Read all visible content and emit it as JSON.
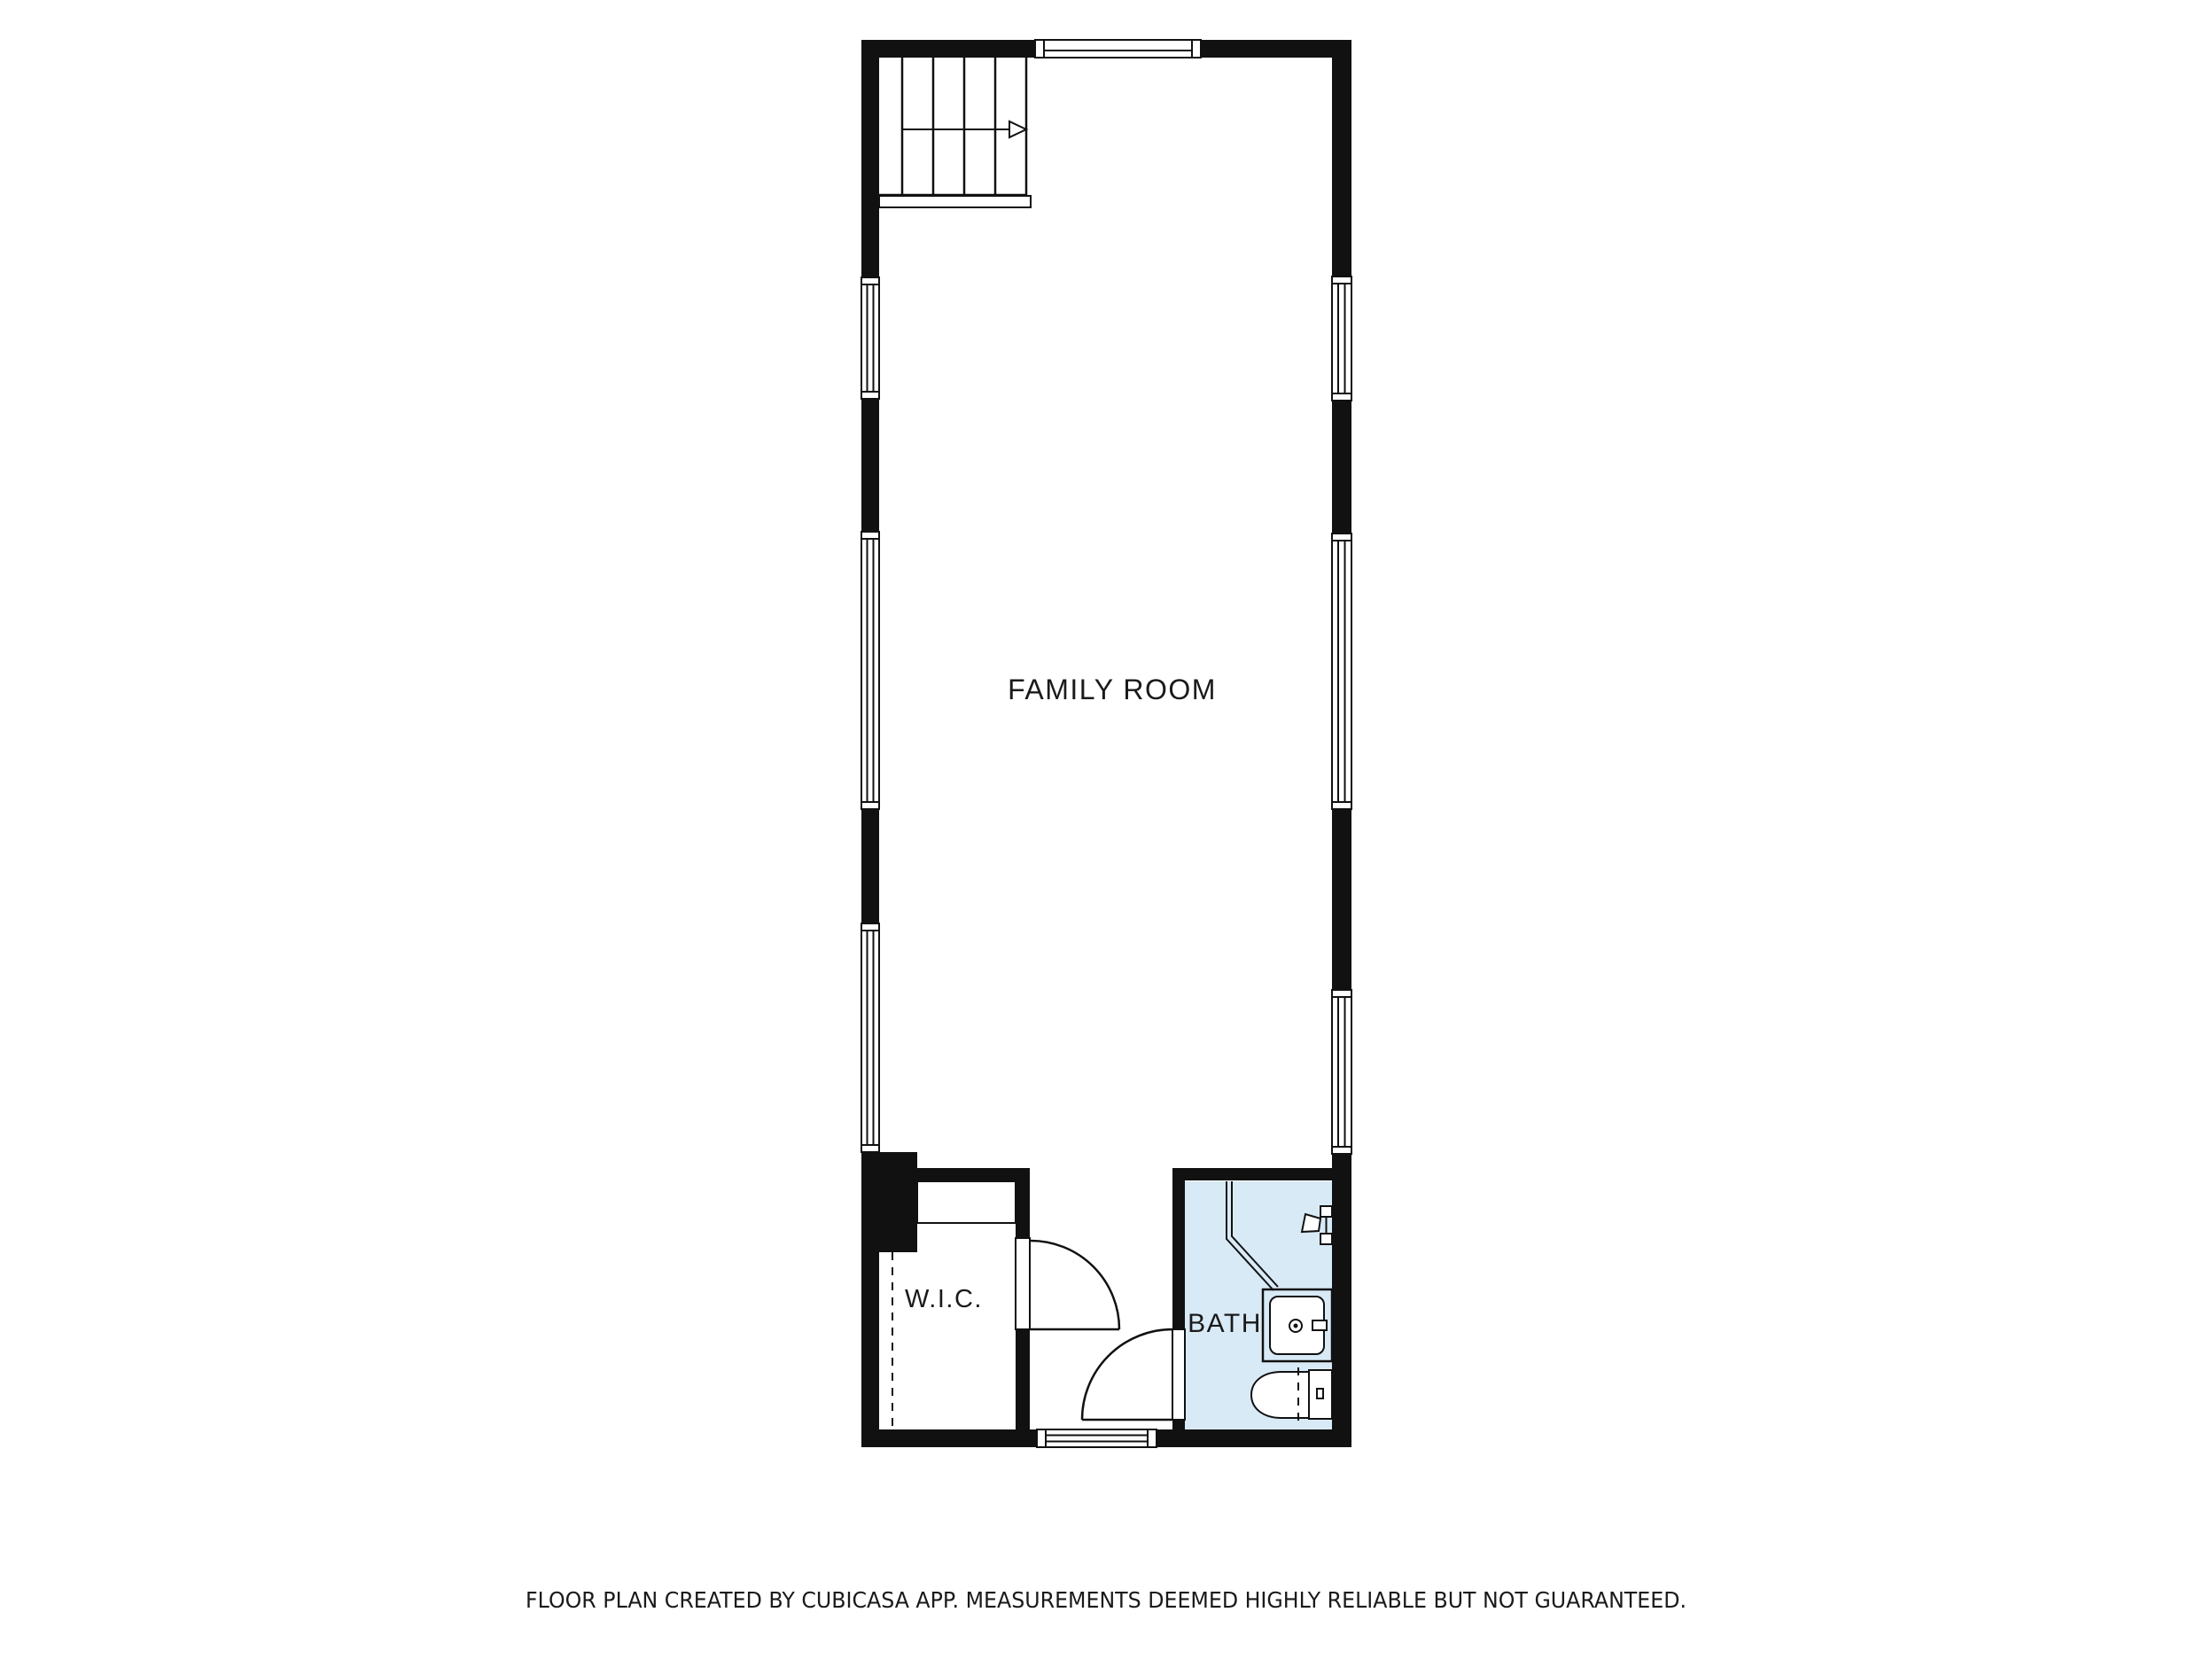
{
  "floor_plan": {
    "labels": {
      "family_room": "FAMILY ROOM",
      "wic": "W.I.C.",
      "bath": "BATH"
    },
    "footer": "FLOOR PLAN CREATED BY CUBICASA APP. MEASUREMENTS DEEMED HIGHLY RELIABLE BUT NOT GUARANTEED.",
    "colors": {
      "wall": "#111111",
      "line": "#111111",
      "bath_fill": "#d9eaf7",
      "fixture_fill": "#ffffff",
      "background": "#ffffff",
      "text": "#1a1a1a"
    },
    "symbols": [
      "staircase-up-arrow-icon",
      "window-icon",
      "door-swing-icon",
      "wardrobe-icon",
      "sloped-ceiling-dashed-line",
      "corner-shower-icon",
      "shower-head-icon",
      "vanity-sink-icon",
      "toilet-icon"
    ]
  }
}
